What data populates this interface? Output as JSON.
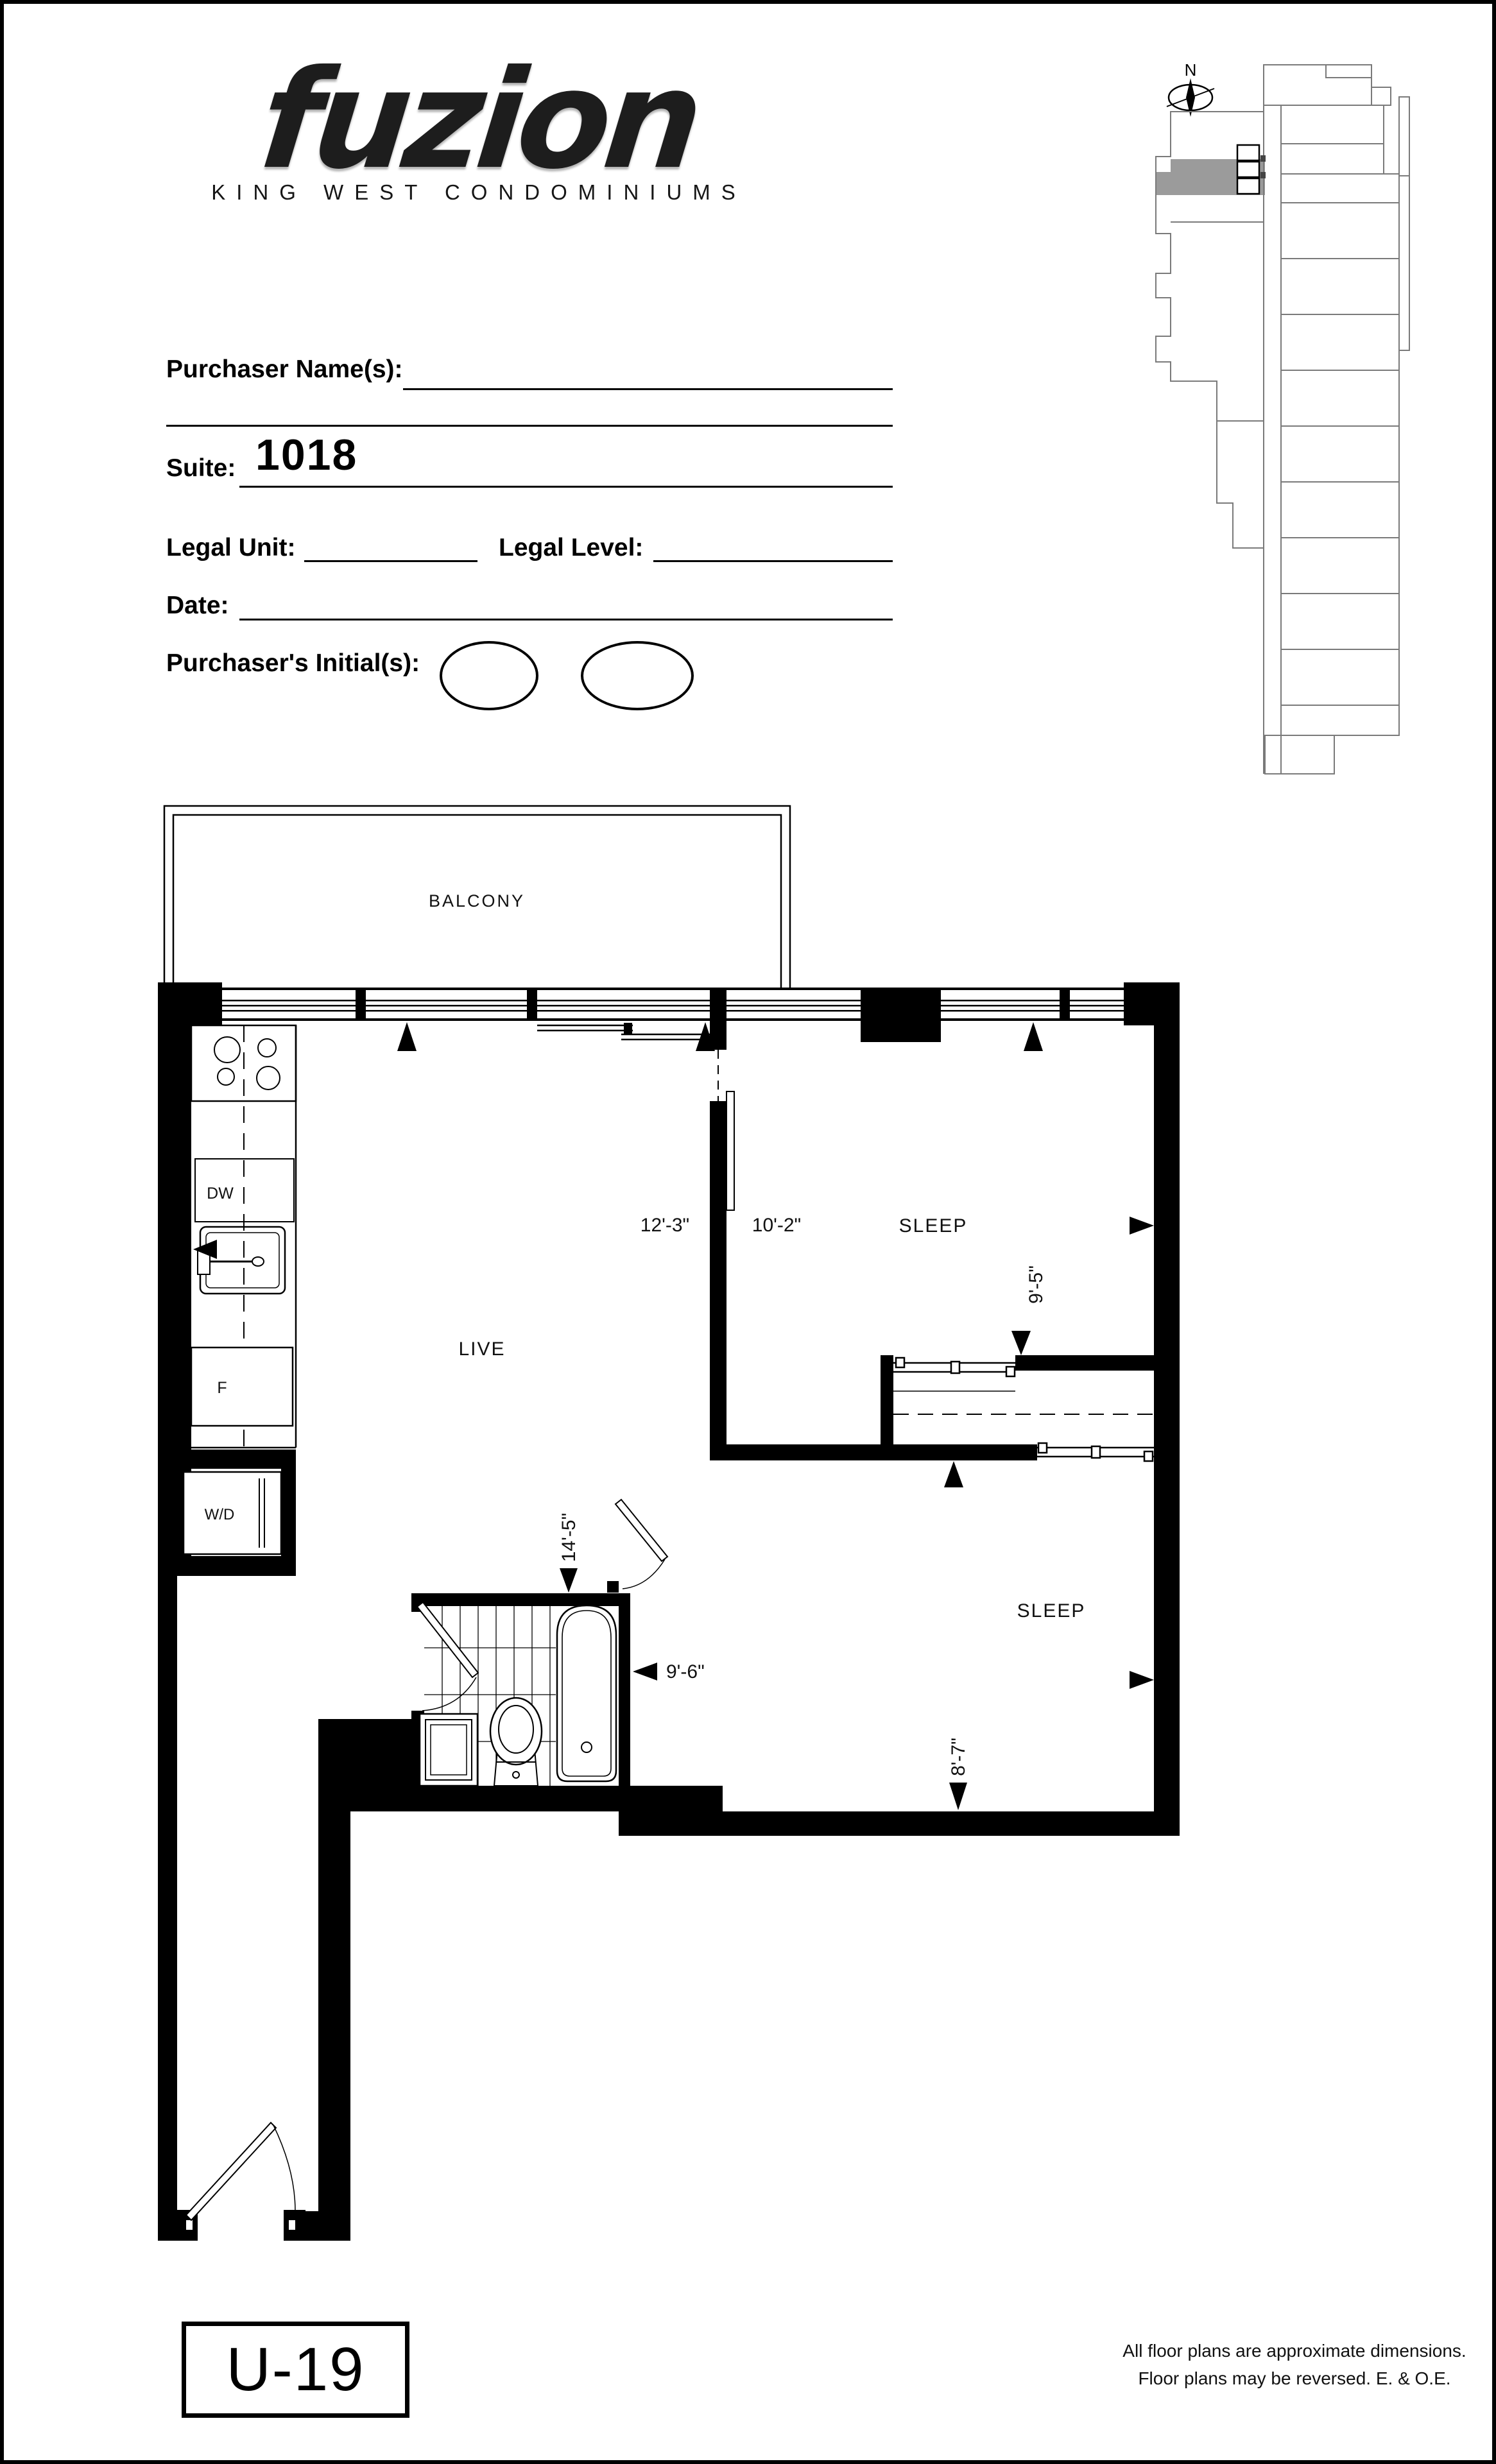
{
  "logo": {
    "brand": "fuzion",
    "subtitle": "KING WEST CONDOMINIUMS"
  },
  "form": {
    "purchaser_label": "Purchaser Name(s):",
    "suite_label": "Suite:",
    "suite_value": "1018",
    "legal_unit_label": "Legal Unit:",
    "legal_level_label": "Legal Level:",
    "date_label": "Date:",
    "initials_label": "Purchaser's Initial(s):"
  },
  "keyplan": {
    "north_label": "N",
    "highlight_color": "#9b9b9b"
  },
  "plan": {
    "rooms": {
      "balcony": "BALCONY",
      "live": "LIVE",
      "sleep1": "SLEEP",
      "sleep2": "SLEEP"
    },
    "appliances": {
      "dw": "DW",
      "fridge": "F",
      "wd": "W/D"
    },
    "dimensions": {
      "live_width": "12'-3\"",
      "sleep1_width": "10'-2\"",
      "sleep1_depth": "9'-5\"",
      "live_depth": "14'-5\"",
      "bath_width": "9'-6\"",
      "sleep2_depth": "8'-7\""
    }
  },
  "footer": {
    "unit_code": "U-19",
    "disclaimer_line1": "All floor plans are approximate dimensions.",
    "disclaimer_line2": "Floor plans may be reversed. E. & O.E."
  }
}
